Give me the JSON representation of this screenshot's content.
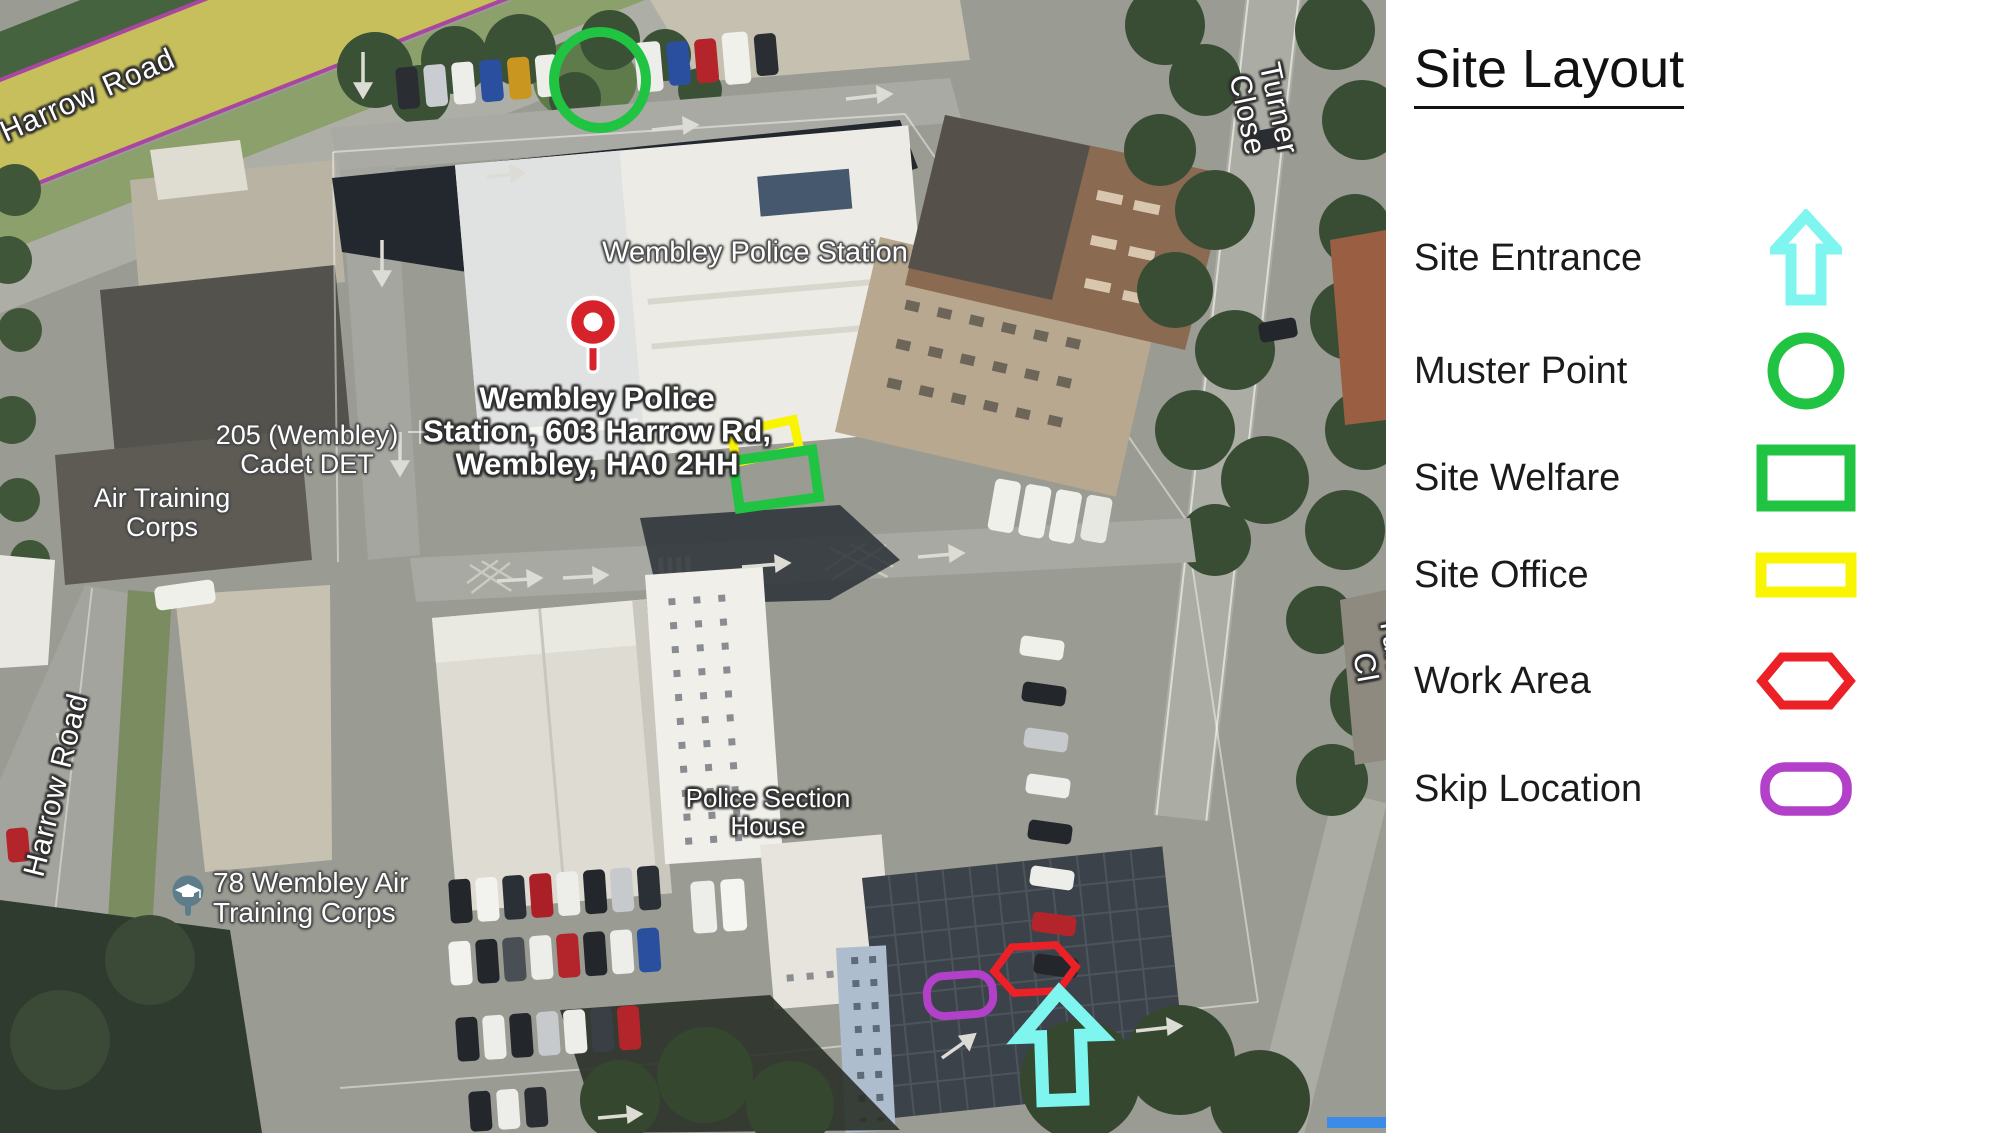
{
  "panel": {
    "title": "Site Layout",
    "items": [
      {
        "label": "Site Entrance",
        "symbol": "entrance-arrow",
        "color": "#7EF5EF"
      },
      {
        "label": "Muster Point",
        "symbol": "circle",
        "color": "#21C442"
      },
      {
        "label": "Site Welfare",
        "symbol": "rectangle",
        "color": "#21C442"
      },
      {
        "label": "Site Office",
        "symbol": "rectangle",
        "color": "#F9F400"
      },
      {
        "label": "Work Area",
        "symbol": "hexagon",
        "color": "#EB2127"
      },
      {
        "label": "Skip Location",
        "symbol": "rounded-rect",
        "color": "#B240C8"
      }
    ]
  },
  "map": {
    "road_labels": {
      "harrow_road_top": "Harrow Road",
      "harrow_road_left": "Harrow Road",
      "turner_close_top": "Turner Close",
      "turner_close_right": "Turner Cl"
    },
    "place_labels": {
      "police_station_roof": "Wembley Police Station",
      "address": "Wembley Police\nStation, 603 Harrow Rd,\nWembley, HA0 2HH",
      "cadet": "205 (Wembley)\nCadet DET",
      "air_training": "Air Training\nCorps",
      "atc78": "78 Wembley Air\nTraining Corps",
      "section_house": "Police Section\nHouse"
    },
    "colors": {
      "entrance": "#7EF5EF",
      "muster": "#21C442",
      "welfare": "#21C442",
      "office": "#F9F400",
      "work": "#EB2127",
      "skip": "#B240C8",
      "pin": "#D6222A",
      "scale_bar": "#3C8CE7"
    }
  }
}
